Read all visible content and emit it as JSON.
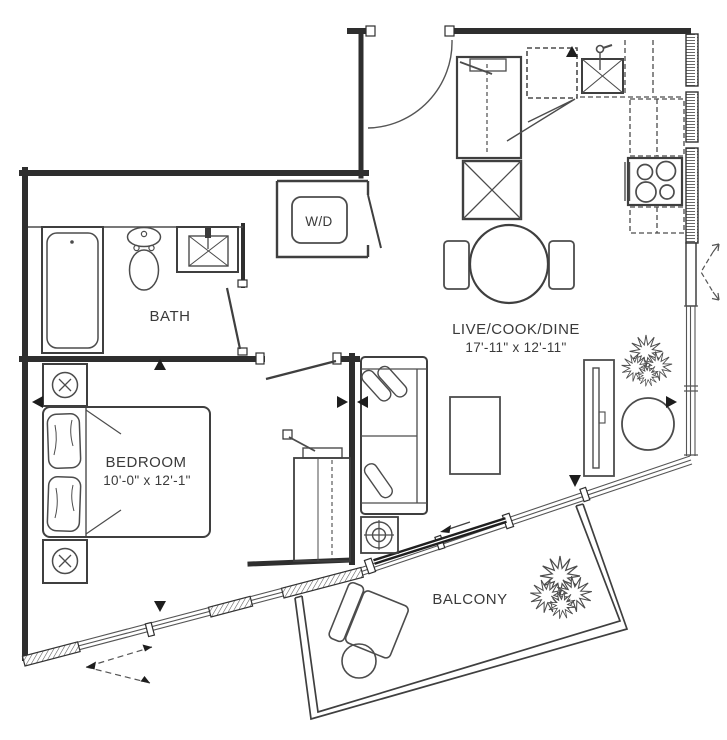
{
  "colors": {
    "background": "#ffffff",
    "wall": "#2e2e2e",
    "line": "#4c4c4c",
    "text": "#3a3a3a"
  },
  "rooms": {
    "bath": {
      "label": "BATH"
    },
    "laundry": {
      "label": "W/D"
    },
    "living": {
      "label": "LIVE/COOK/DINE",
      "dims": "17'-11\" x 12'-11\""
    },
    "bedroom": {
      "label": "BEDROOM",
      "dims": "10'-0\" x 12'-1\""
    },
    "balcony": {
      "label": "BALCONY"
    }
  }
}
